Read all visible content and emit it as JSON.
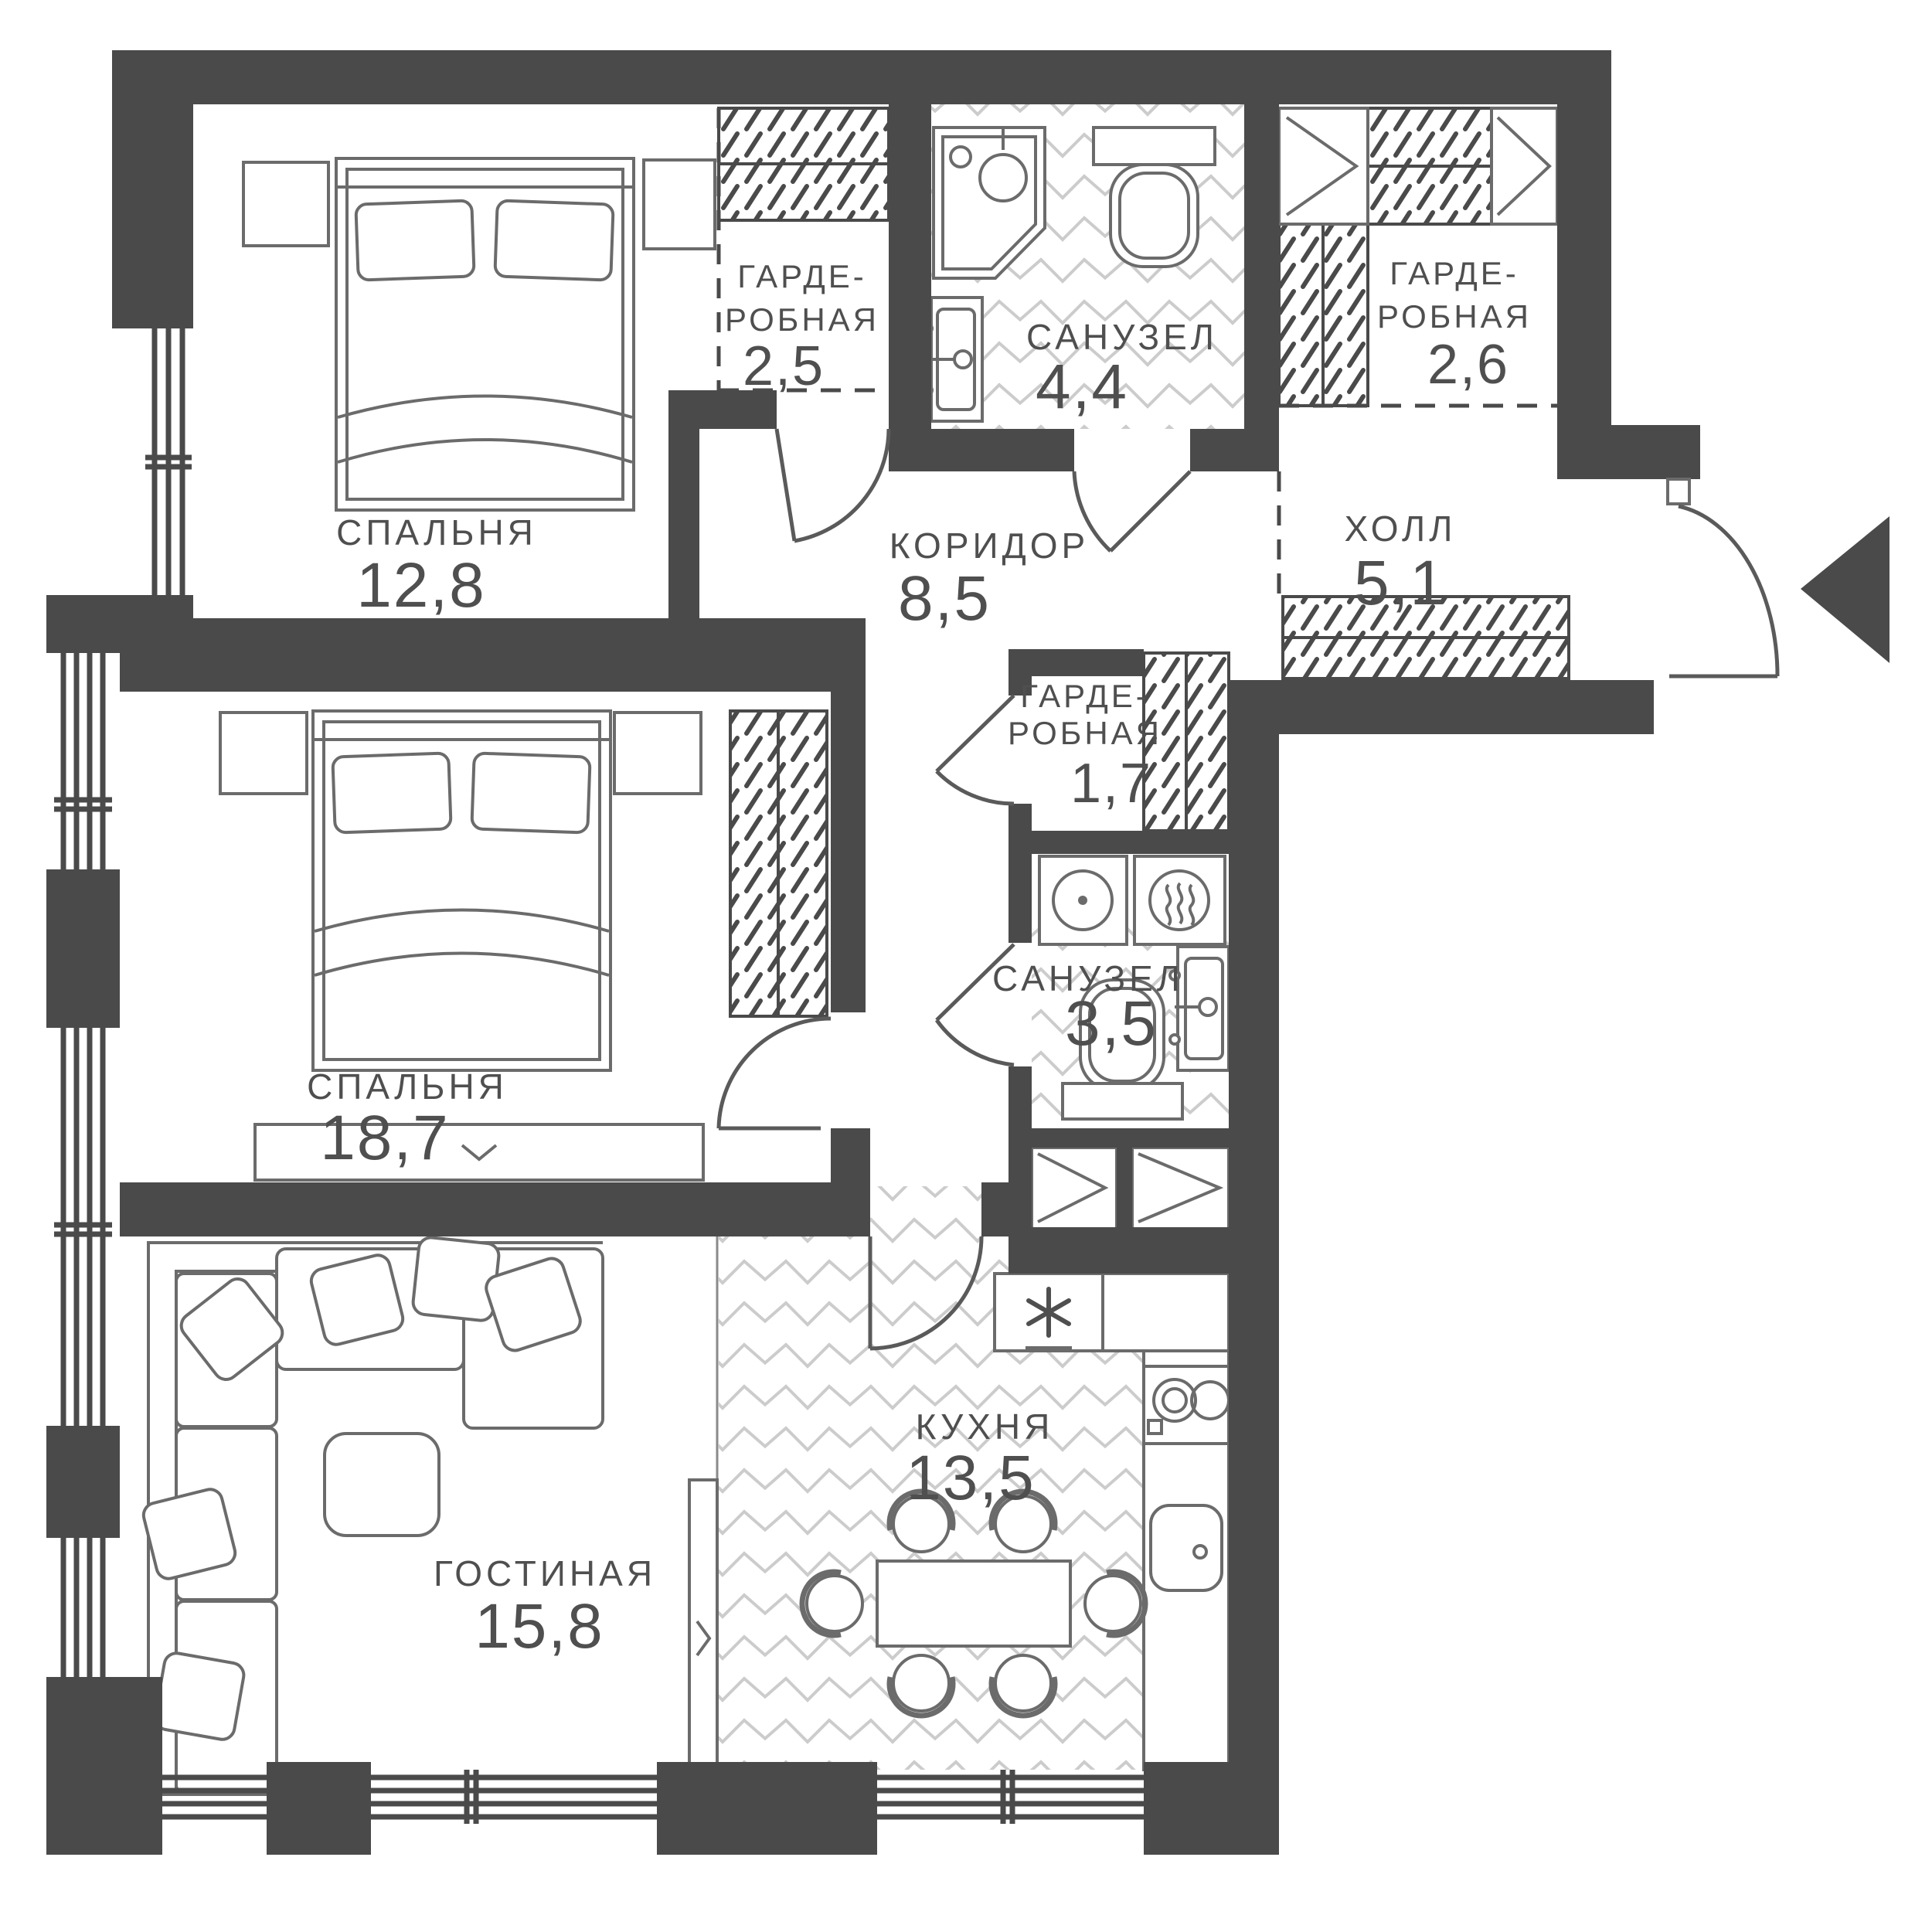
{
  "plan_title": "apartment-floor-plan",
  "rooms": {
    "bedroom1": {
      "name": "СПАЛЬНЯ",
      "area": "12,8"
    },
    "bedroom2": {
      "name": "СПАЛЬНЯ",
      "area": "18,7"
    },
    "living": {
      "name": "ГОСТИНАЯ",
      "area": "15,8"
    },
    "kitchen": {
      "name": "КУХНЯ",
      "area": "13,5"
    },
    "corridor": {
      "name": "КОРИДОР",
      "area": "8,5"
    },
    "hall": {
      "name": "ХОЛЛ",
      "area": "5,1"
    },
    "bathroom_main": {
      "name": "САНУЗЕЛ",
      "area": "4,4"
    },
    "bathroom_small": {
      "name": "САНУЗЕЛ",
      "area": "3,5"
    },
    "wardrobe_top": {
      "name_line1": "ГАРДЕ-",
      "name_line2": "РОБНАЯ",
      "area": "2,5"
    },
    "wardrobe_right": {
      "name_line1": "ГАРДЕ-",
      "name_line2": "РОБНАЯ",
      "area": "2,6"
    },
    "wardrobe_mid": {
      "name_line1": "ГАРДЕ-",
      "name_line2": "РОБНАЯ",
      "area": "1,7"
    }
  },
  "entrance": {
    "symbol": "arrow-left"
  },
  "colors": {
    "wall": "#4a4a4a",
    "furniture_line": "#6b6b6b",
    "zigzag_floor": "#cccccc",
    "text": "#4f4f4f",
    "background": "#ffffff"
  }
}
